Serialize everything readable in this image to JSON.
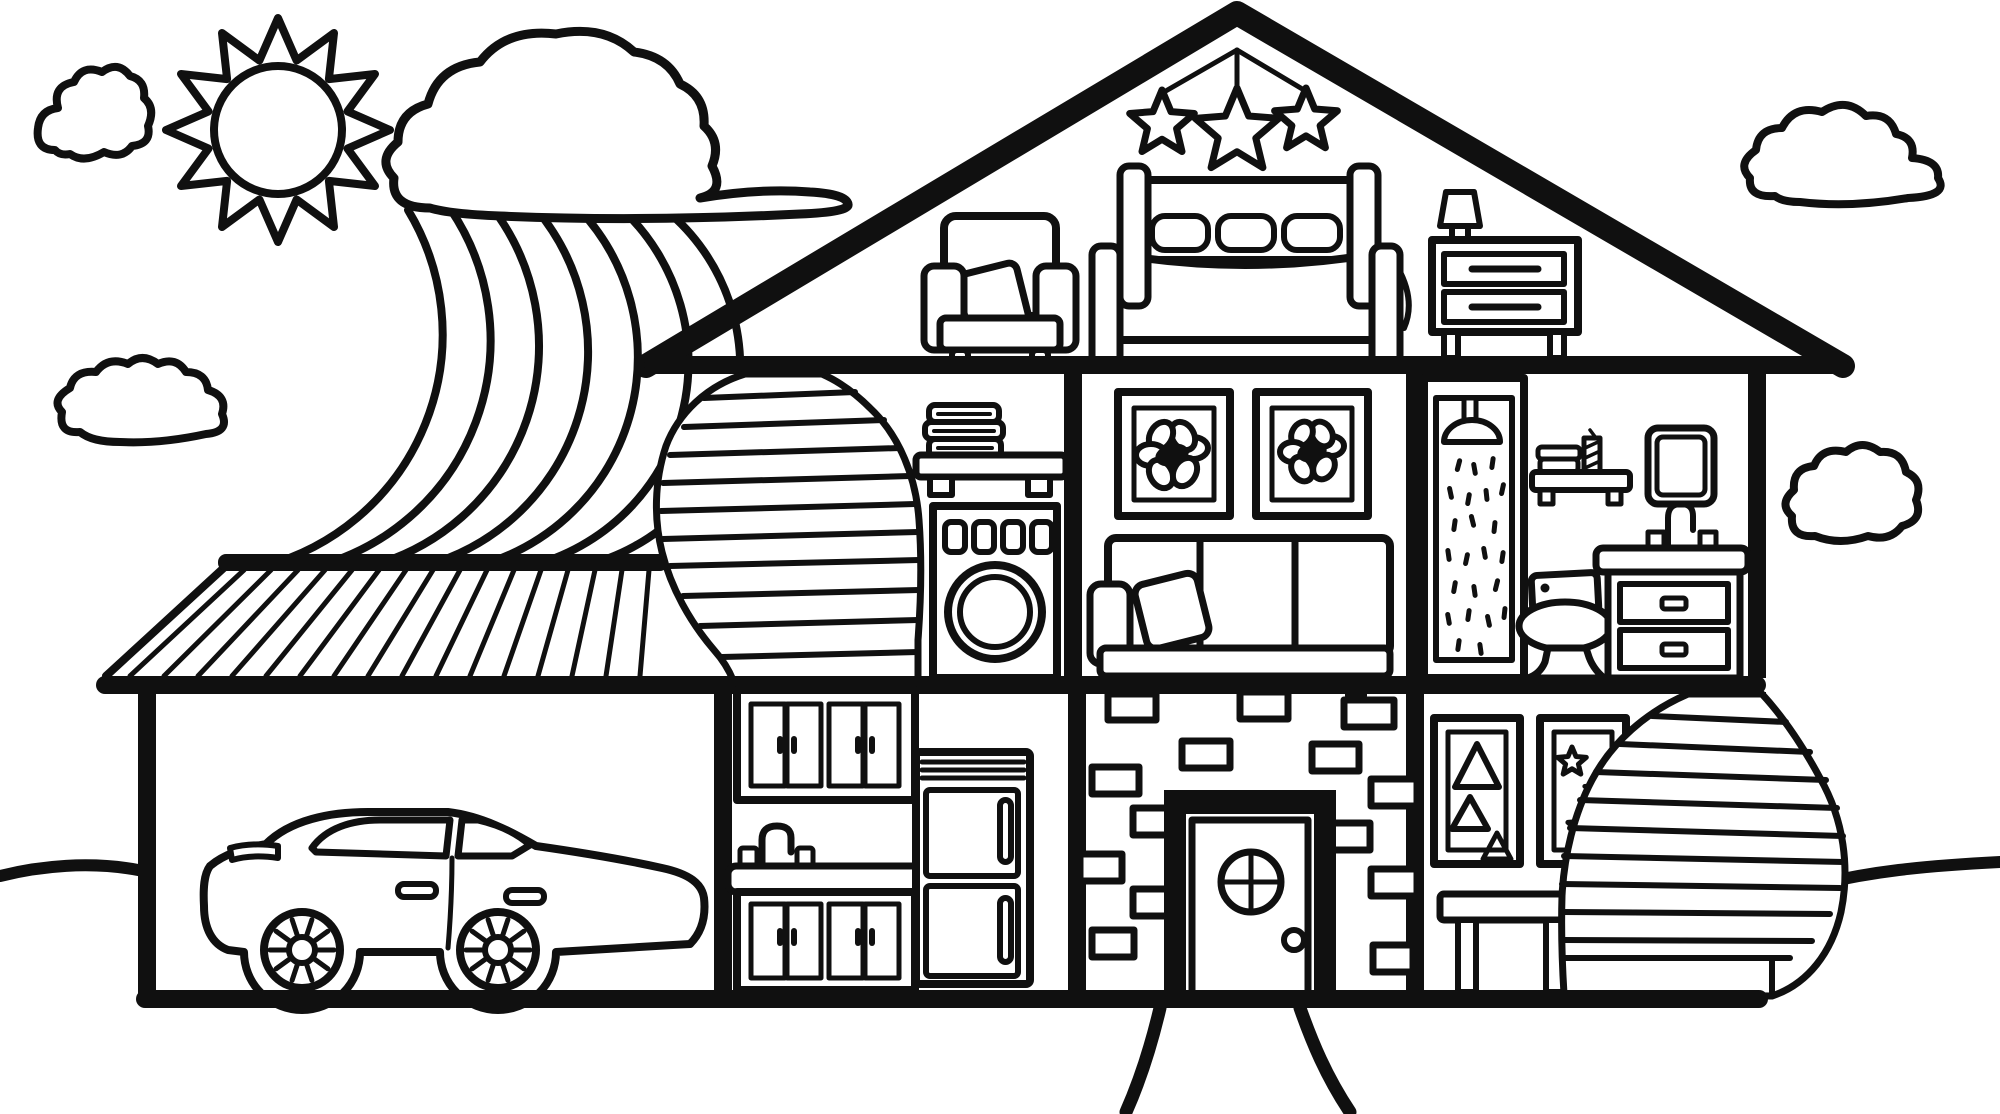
{
  "title": "house cutaway coloring page",
  "palette": {
    "line": "#101010",
    "background": "#ffffff"
  },
  "sky": {
    "sun": "spiky sun with inner circle",
    "clouds": [
      "top-left cloud",
      "mid-left cloud",
      "large cloud over rainbow",
      "top-right cloud",
      "right-side small cloud"
    ],
    "rainbow": {
      "bands": 7,
      "from": "under large cloud",
      "to": "behind garage roof"
    }
  },
  "house": {
    "attic_bedroom": [
      "three hanging stars on strings",
      "armchair with pillow",
      "double bed with headboard and three pillows",
      "nightstand with two drawers",
      "table lamp"
    ],
    "second_floor": {
      "stairwell": "curved staircase to attic",
      "laundry": [
        "wall shelf with folded towels",
        "washing machine with four buttons and round door"
      ],
      "living_room": [
        "two framed flower pictures",
        "sofa with pillow"
      ],
      "bathroom": [
        "shower stall with shower head and water drops",
        "shelf with towels and candle",
        "mirror",
        "toilet",
        "sink vanity with faucet and two drawers"
      ]
    },
    "ground_floor": {
      "garage": [
        "sedan car with two spoked wheels"
      ],
      "kitchen": [
        "upper cabinets",
        "sink with gooseneck faucet",
        "lower cabinets",
        "refrigerator with two doors"
      ],
      "entry": [
        "scattered bricks wall",
        "door with round window and knob"
      ],
      "playroom": [
        "framed picture with triangles",
        "framed picture with stars",
        "stool",
        "curved staircase down"
      ]
    },
    "structure": [
      "gable roof",
      "attic floor",
      "second floor slab",
      "ground slab",
      "garage hatched roof"
    ]
  },
  "ground": {
    "left_line": 1,
    "right_line": 1,
    "walkway_curves": 2
  },
  "counts": {
    "rainbow_bands": 7,
    "hanging_stars": 3,
    "bricks": 14,
    "flower_pictures": 2,
    "car_wheels": 2
  }
}
